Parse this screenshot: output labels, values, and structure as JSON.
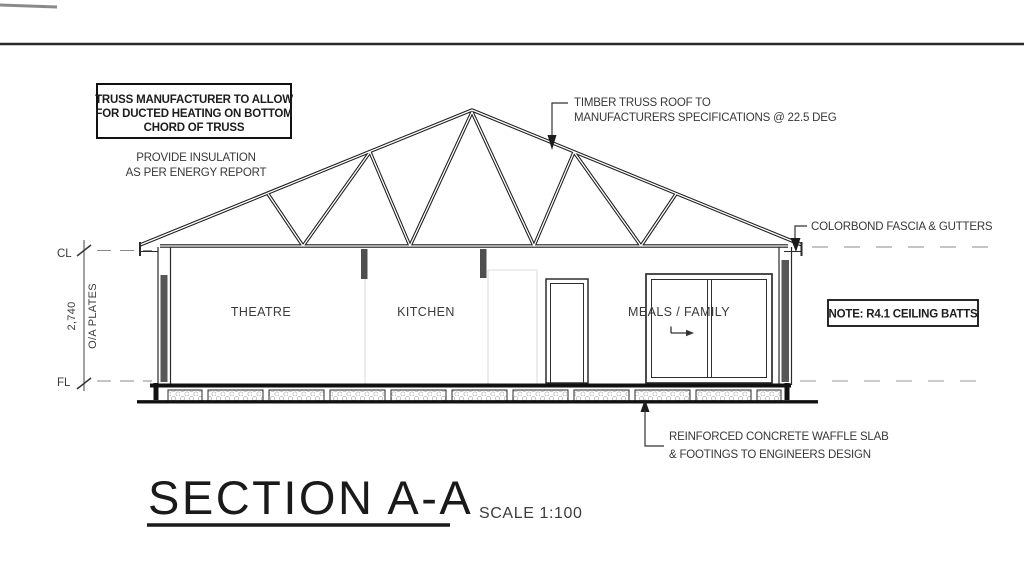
{
  "drawing": {
    "title": "SECTION A-A",
    "scale_label": "SCALE 1:100",
    "rooms": [
      "THEATRE",
      "KITCHEN",
      "MEALS / FAMILY"
    ],
    "levels": {
      "cl": "CL",
      "fl": "FL"
    },
    "dimension": {
      "value": "2,740",
      "label": "O/A PLATES"
    },
    "notes": {
      "truss_box": [
        "TRUSS MANUFACTURER TO ALLOW",
        "FOR DUCTED HEATING ON BOTTOM",
        "CHORD OF TRUSS"
      ],
      "insulation": [
        "PROVIDE INSULATION",
        "AS PER ENERGY REPORT"
      ],
      "timber_truss": [
        "TIMBER TRUSS ROOF TO",
        "MANUFACTURERS SPECIFICATIONS @ 22.5 DEG"
      ],
      "fascia": "COLORBOND FASCIA & GUTTERS",
      "ceiling_batts": "NOTE: R4.1 CEILING BATTS",
      "slab": [
        "REINFORCED CONCRETE WAFFLE SLAB",
        "& FOOTINGS TO ENGINEERS DESIGN"
      ]
    },
    "truss_pitch_deg": "22.5",
    "colors": {
      "ink": "#1c1c1c",
      "annotation": "#383838",
      "faint_line": "#dcdcdc",
      "insulation_fill": "#575757",
      "dashed_line": "#8a8a8a",
      "pod_hatch": "#b8b8b8",
      "background": "#ffffff"
    }
  }
}
